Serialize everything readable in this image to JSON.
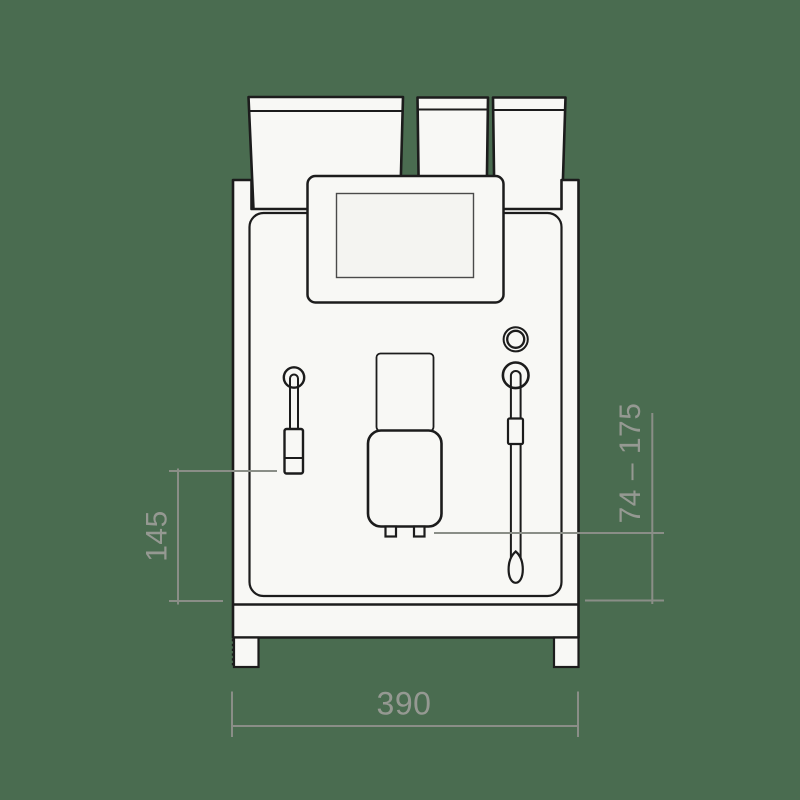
{
  "diagram": {
    "subject": "coffee-machine-front-view-dimension-drawing",
    "dimensions": {
      "frother_height": {
        "label": "145",
        "orientation": "vertical",
        "side": "left"
      },
      "spout_height_range": {
        "label": "74 – 175",
        "orientation": "vertical",
        "side": "right"
      },
      "machine_width": {
        "label": "390",
        "orientation": "horizontal",
        "side": "bottom"
      }
    }
  },
  "colors": {
    "background": "#4a6c50",
    "outline": "#1c1c1c",
    "machine_fill": "#f8f8f5",
    "screen_fill": "#f4f4f1",
    "dimension_line": "#8a8e87",
    "dimension_text": "#959992"
  }
}
